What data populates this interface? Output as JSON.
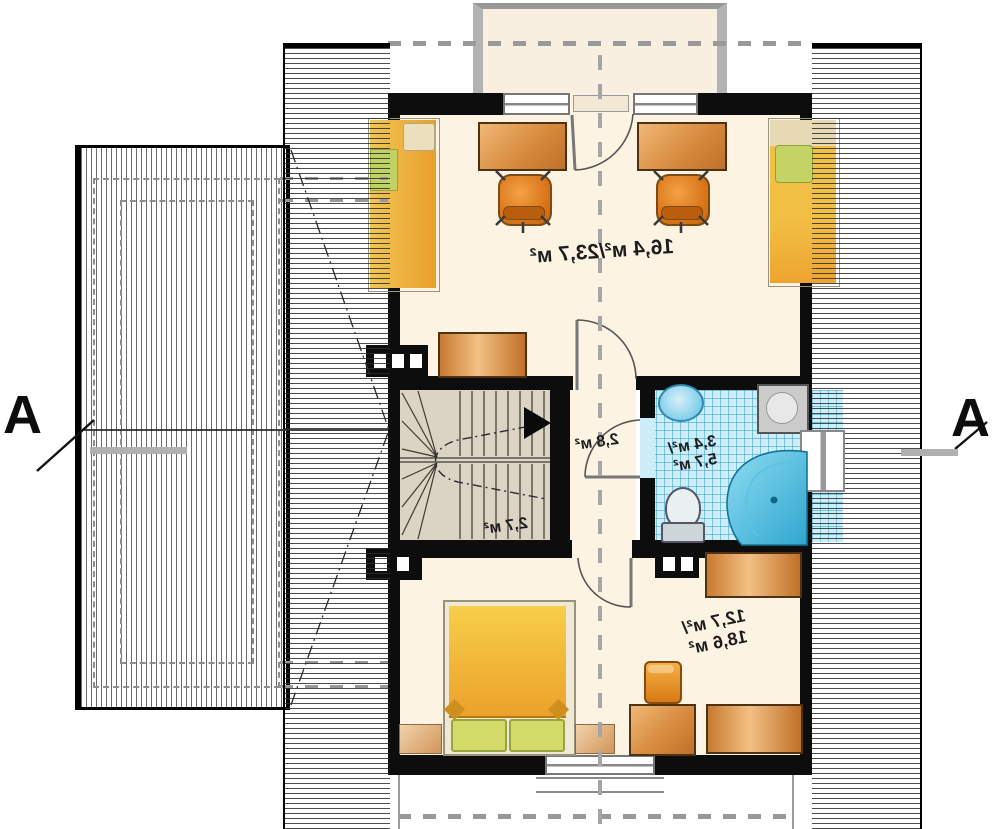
{
  "rooms": {
    "top_room_area": "16,4 м²/23,7 м²",
    "hall_area": "2,8 м²",
    "stairs_area": "2,7 м²",
    "bathroom_area_line1": "3,4 м²/",
    "bathroom_area_line2": "5,7 м²",
    "bedroom_area_line1": "12,7 м²/",
    "bedroom_area_line2": "18,6 м²"
  },
  "section_markers": {
    "left": "A",
    "right": "A"
  },
  "colors": {
    "wall": "#0d0d0d",
    "floor_cream": "#fcf3e3",
    "stairs_floor": "#dbd4c4",
    "bath_tile": "#cdeef8",
    "furniture_orange": "#d88b3e",
    "bed_yellow": "#f2bf45",
    "pillow_green": "#ccd863",
    "tub_blue": "#2fa6cf",
    "roof_hatch": "#2d2d2d"
  }
}
